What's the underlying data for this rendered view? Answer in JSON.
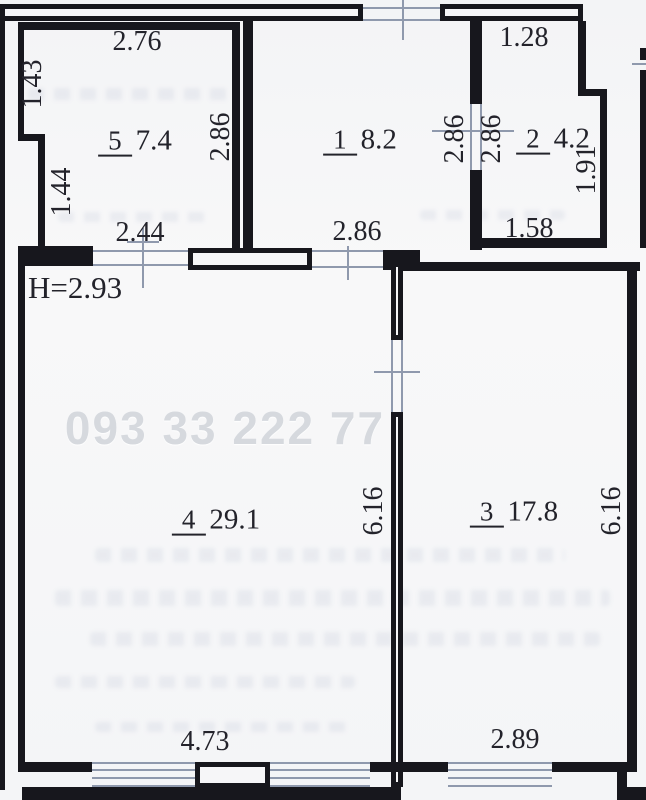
{
  "plan": {
    "watermark": "093 33 222 77",
    "height_note": "H=2.93"
  },
  "rooms": {
    "r5": {
      "number": "5",
      "area": "7.4"
    },
    "r1": {
      "number": "1",
      "area": "8.2"
    },
    "r2": {
      "number": "2",
      "area": "4.2"
    },
    "r4": {
      "number": "4",
      "area": "29.1"
    },
    "r3": {
      "number": "3",
      "area": "17.8"
    }
  },
  "dims": {
    "r5_top": "2.76",
    "r5_left_upper": "1.43",
    "r5_left_lower": "1.44",
    "r5_right": "2.86",
    "r5_door": "2.44",
    "r1_bottom": "2.86",
    "door12_left": "2.86",
    "door12_right": "2.86",
    "r2_top": "1.28",
    "r2_right": "1.91",
    "r2_bottom": "1.58",
    "r4_right": "6.16",
    "r4_bottom": "4.73",
    "r3_right": "6.16",
    "r3_bottom": "2.89"
  },
  "colors": {
    "wall": "#17171d",
    "line": "#8f99ad",
    "text": "#23232b",
    "paper": "#f6f6f8",
    "watermark": "#d6d9de"
  }
}
